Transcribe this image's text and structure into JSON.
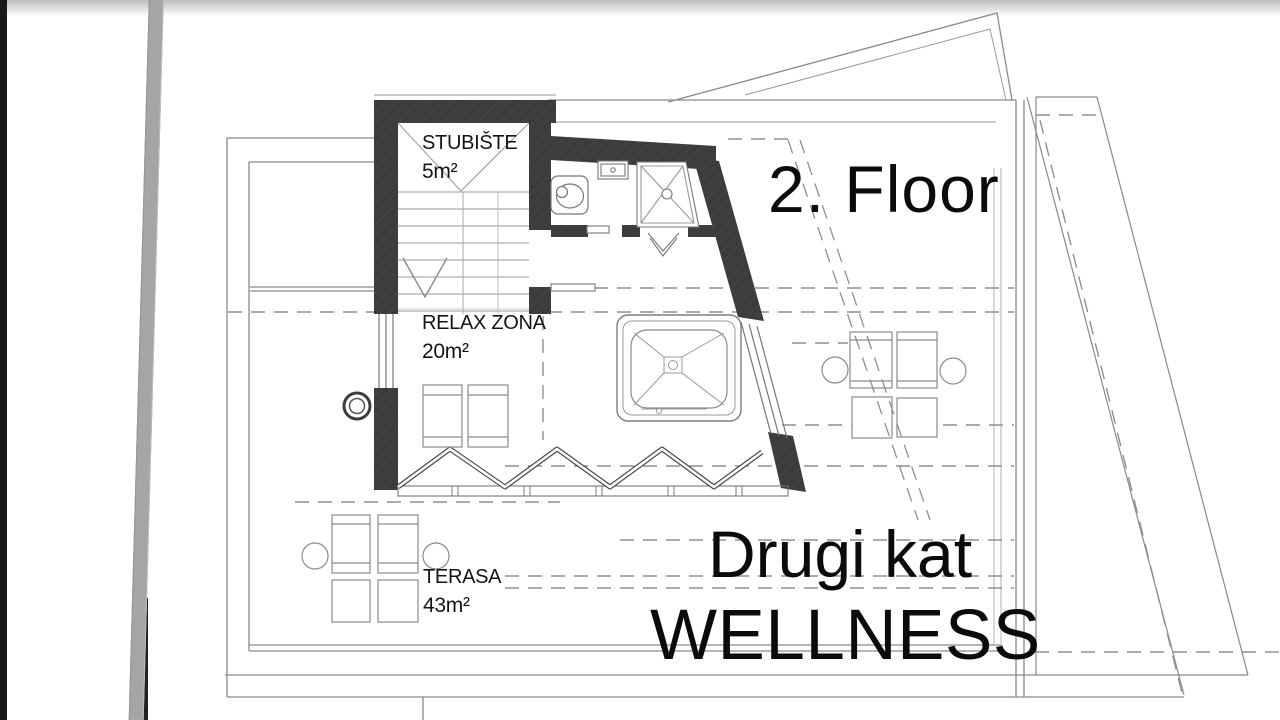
{
  "page": {
    "background": "#ffffff",
    "left_edge_color": "#181818",
    "divider_color": "#a5a5a5"
  },
  "plan": {
    "rooms": [
      {
        "name": "STUBIŠTE",
        "area": "5m²"
      },
      {
        "name": "RELAX ZONA",
        "area": "20m²"
      },
      {
        "name": "TERASA",
        "area": "43m²"
      }
    ],
    "annotations": {
      "floor_en": "2. Floor",
      "floor_hr": "Drugi kat",
      "zone": "WELLNESS"
    },
    "colors": {
      "wall": "#3c3c3c",
      "line": "#8a8a8a",
      "dashed": "#8f8f8f",
      "text": "#111111"
    }
  }
}
